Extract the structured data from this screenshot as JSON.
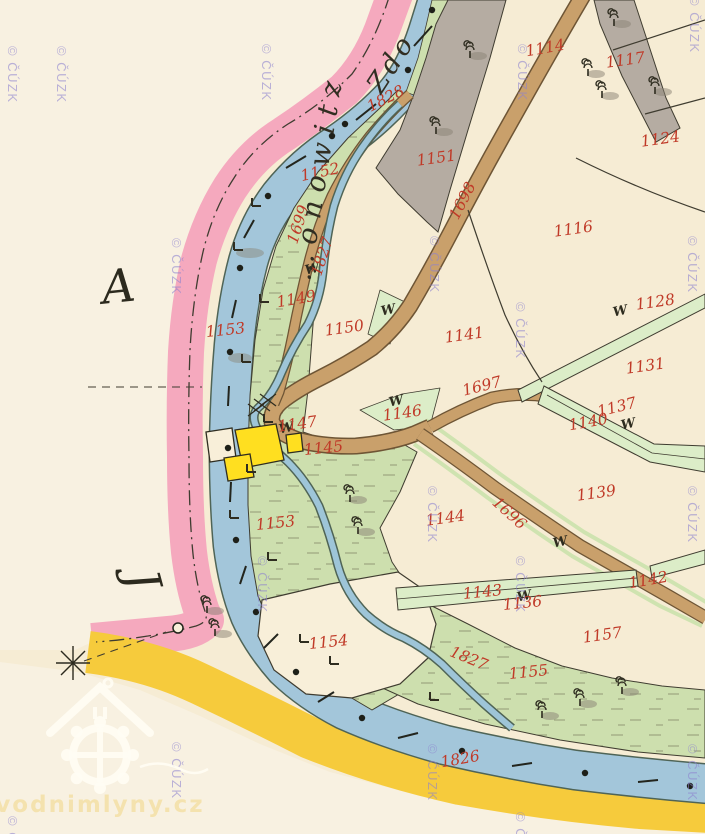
{
  "map": {
    "title": "Historical cadastral map sheet (scanned)",
    "provider_watermark": "© ČÚZK",
    "source_logo": "vodnimlyny.cz"
  },
  "place_names": {
    "left_fragment": "…onowitz",
    "top_fragment": "Zdo"
  },
  "letters": {
    "a": "A",
    "j": "J"
  },
  "symbols": {
    "meadow": "W"
  },
  "parcels": [
    {
      "t": "1828",
      "kind": "watercourse"
    },
    {
      "t": "1114",
      "kind": "parcel"
    },
    {
      "t": "1117",
      "kind": "parcel"
    },
    {
      "t": "1124",
      "kind": "parcel"
    },
    {
      "t": "1151",
      "kind": "parcel"
    },
    {
      "t": "1152",
      "kind": "parcel"
    },
    {
      "t": "1698",
      "kind": "road"
    },
    {
      "t": "1116",
      "kind": "parcel"
    },
    {
      "t": "1699",
      "kind": "road"
    },
    {
      "t": "1827",
      "kind": "watercourse"
    },
    {
      "t": "1149",
      "kind": "parcel"
    },
    {
      "t": "1150",
      "kind": "parcel"
    },
    {
      "t": "1153",
      "kind": "parcel"
    },
    {
      "t": "1141",
      "kind": "parcel"
    },
    {
      "t": "1128",
      "kind": "parcel"
    },
    {
      "t": "1131",
      "kind": "parcel"
    },
    {
      "t": "1697",
      "kind": "road"
    },
    {
      "t": "1137",
      "kind": "parcel"
    },
    {
      "t": "1140",
      "kind": "parcel"
    },
    {
      "t": "1146",
      "kind": "parcel"
    },
    {
      "t": "1147",
      "kind": "parcel"
    },
    {
      "t": "1145",
      "kind": "parcel"
    },
    {
      "t": "1139",
      "kind": "parcel"
    },
    {
      "t": "1144",
      "kind": "parcel"
    },
    {
      "t": "1696",
      "kind": "road"
    },
    {
      "t": "1153",
      "kind": "parcel"
    },
    {
      "t": "1143",
      "kind": "parcel"
    },
    {
      "t": "1136",
      "kind": "parcel"
    },
    {
      "t": "1142",
      "kind": "parcel"
    },
    {
      "t": "1157",
      "kind": "parcel"
    },
    {
      "t": "1154",
      "kind": "parcel"
    },
    {
      "t": "1827",
      "kind": "watercourse"
    },
    {
      "t": "1155",
      "kind": "parcel"
    },
    {
      "t": "1826",
      "kind": "watercourse"
    }
  ],
  "colors": {
    "paper": "#f6ecd4",
    "enclave_paper": "#f8f1e1",
    "pink_boundary_band": "#f5a9be",
    "yellow_boundary_band": "#f6cb3c",
    "river_blue": "#a3c6da",
    "meadow_green": "#cddfae",
    "path_strip_green": "#dcedc8",
    "road_tan": "#c9a06b",
    "gray_area": "#b5aca2",
    "building_yellow": "#ffdf20",
    "label_red": "#c03a28",
    "ink": "#3f3c30",
    "watermark": "#8d82cf"
  }
}
